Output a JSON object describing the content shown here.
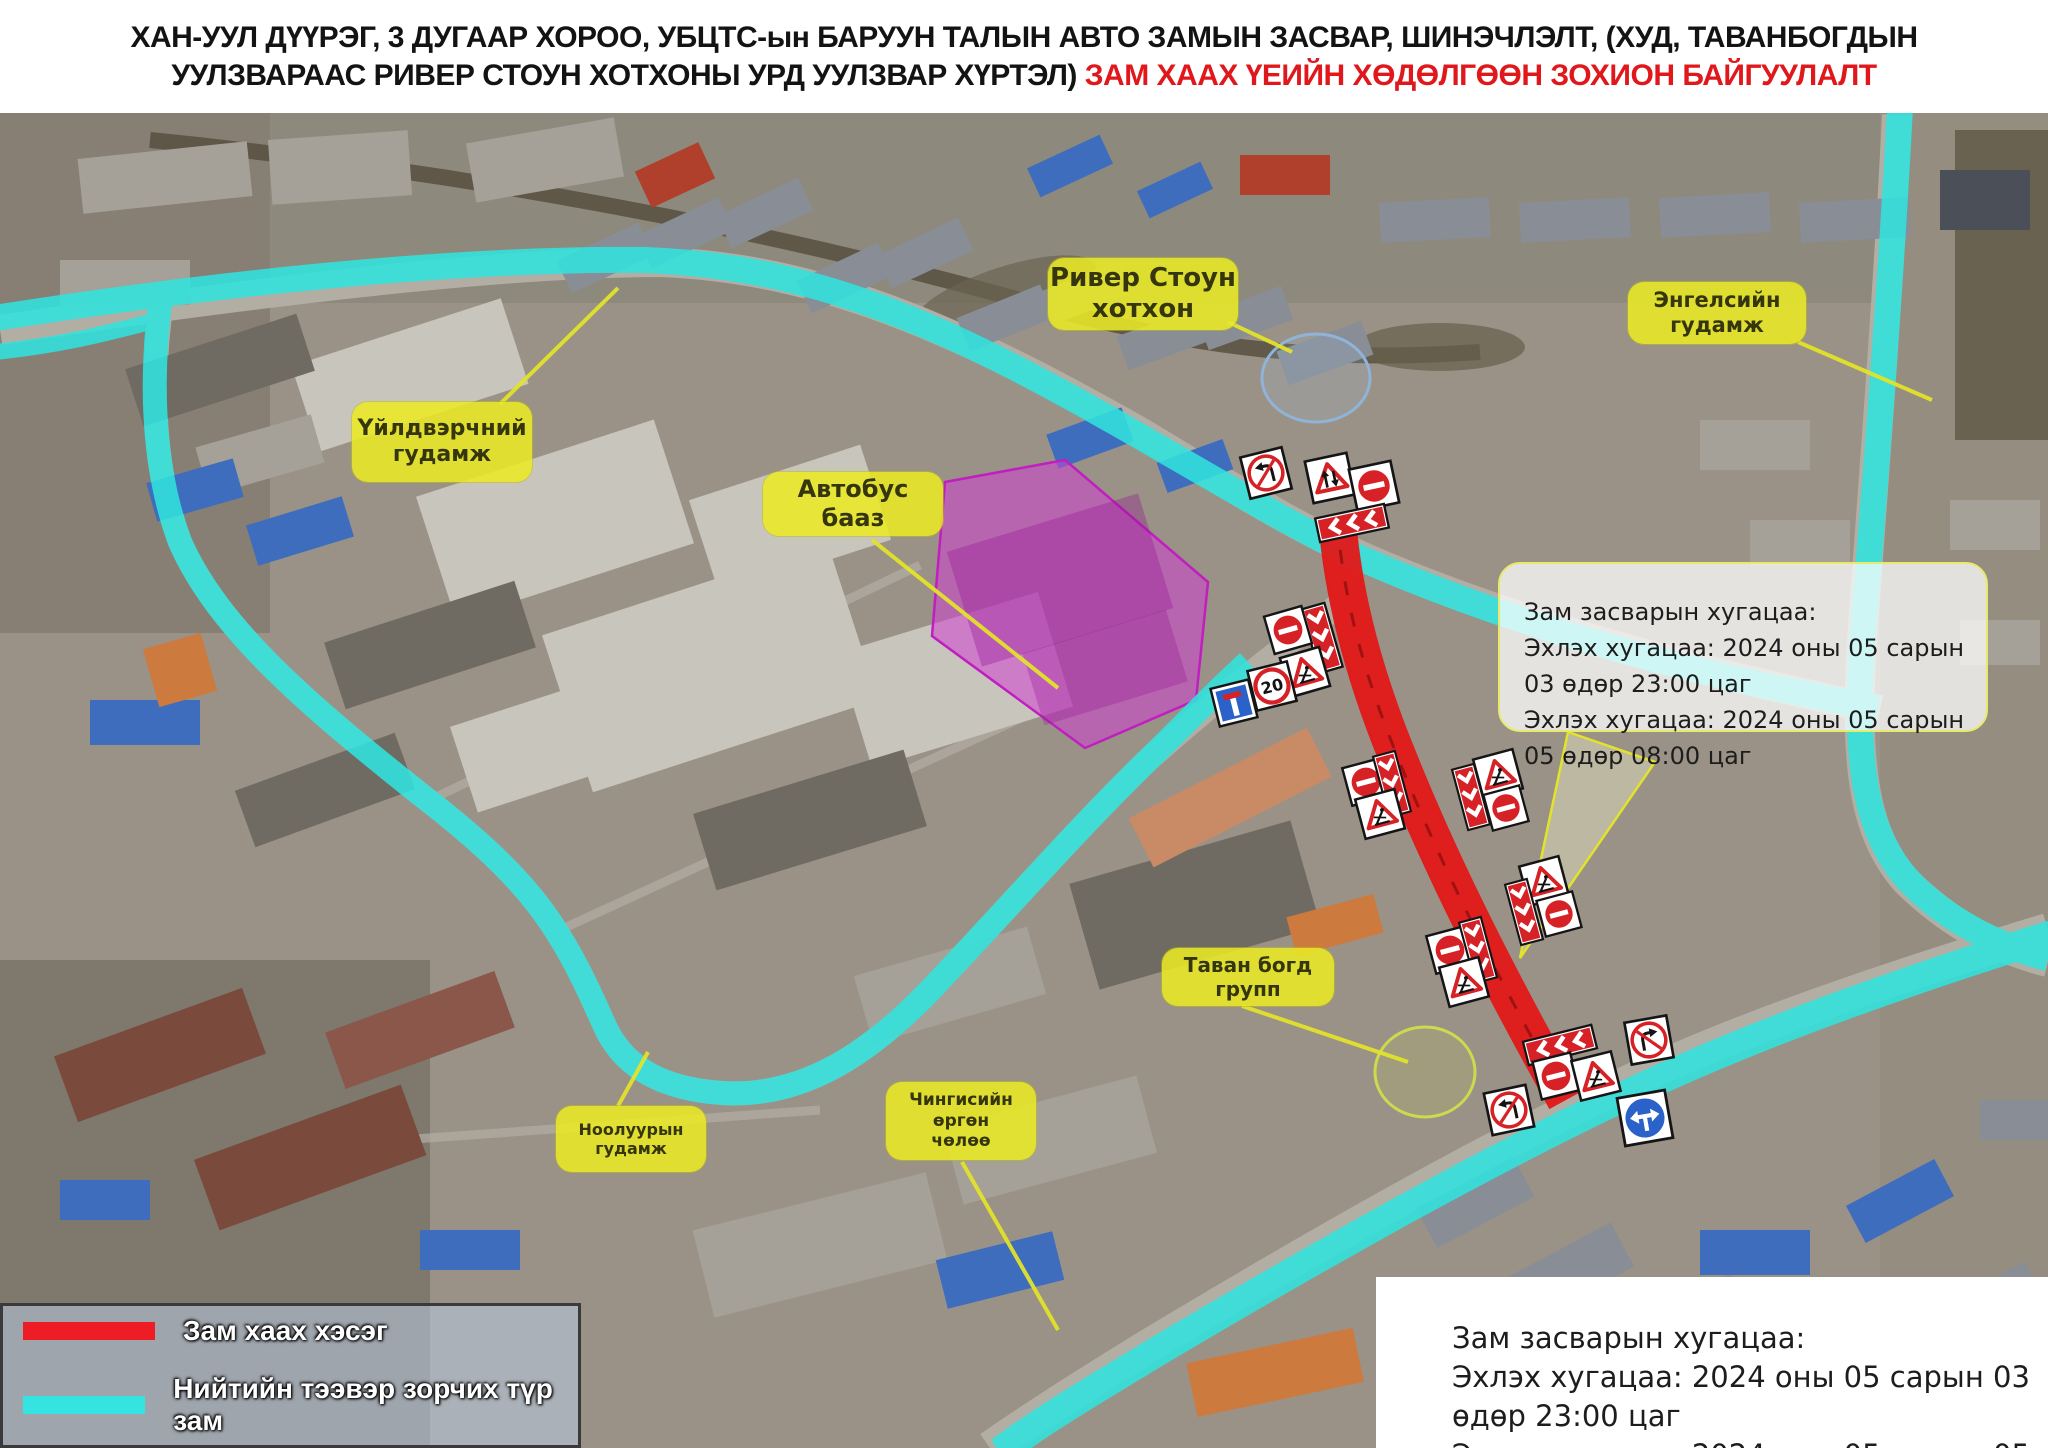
{
  "header": {
    "title_line1": "ХАН-УУЛ ДҮҮРЭГ, 3 ДУГААР ХОРОО, УБЦТС-ын БАРУУН ТАЛЫН АВТО ЗАМЫН  ЗАСВАР, ШИНЭЧЛЭЛТ, (ХУД, ТАВАНБОГДЫН",
    "title_line2_black": "УУЛЗВАРААС  РИВЕР СТОУН ХОТХОНЫ УРД УУЛЗВАР ХҮРТЭЛ) ",
    "title_line2_red": "ЗАМ ХААХ ҮЕИЙН ХӨДӨЛГӨӨН ЗОХИОН БАЙГУУЛАЛТ"
  },
  "map_labels": {
    "river_stone": {
      "line1": "Ривер Стоун",
      "line2": "хотхон"
    },
    "engels_street": {
      "text": "Энгелсийн гудамж"
    },
    "uildverchnii_street": {
      "line1": "Үйлдвэрчний",
      "line2": "гудамж"
    },
    "bus_depot": {
      "text": "Автобус бааз"
    },
    "tavan_bogd": {
      "text": "Таван богд групп"
    },
    "nooluuryn_street": {
      "text": "Ноолуурын гудамж"
    },
    "chinggis_avenue": {
      "line1": "Чингисийн өргөн",
      "line2": "чөлөө"
    }
  },
  "callout_box": {
    "heading": "Зам засварын хугацаа:",
    "line1": "Эхлэх хугацаа: 2024 оны 05 сарын 03 өдөр 23:00 цаг",
    "line2": "Эхлэх хугацаа: 2024 оны 05 сарын 05 өдөр 08:00 цаг"
  },
  "schedule_box": {
    "heading": "Зам засварын хугацаа:",
    "line1": "Эхлэх хугацаа: 2024 оны 05 сарын 03 өдөр 23:00 цаг",
    "line2": "Эхлэх хугацаа: 2024 оны 05 сарын 05 өдөр 08:00 цаг"
  },
  "legend": {
    "closed_label": "Зам хаах хэсэг",
    "transit_label": "Нийтийн тээвэр зорчих түр зам",
    "closed_color": "#ee1c25",
    "transit_color": "#35e3e0"
  },
  "signs": {
    "speed_limit": "20"
  },
  "colors": {
    "closed_road": "#e21717",
    "transit_route": "#31e3de",
    "bus_depot_fill": "#d23fd2",
    "label_bg": "#e9e926",
    "title_red": "#e0181c"
  }
}
